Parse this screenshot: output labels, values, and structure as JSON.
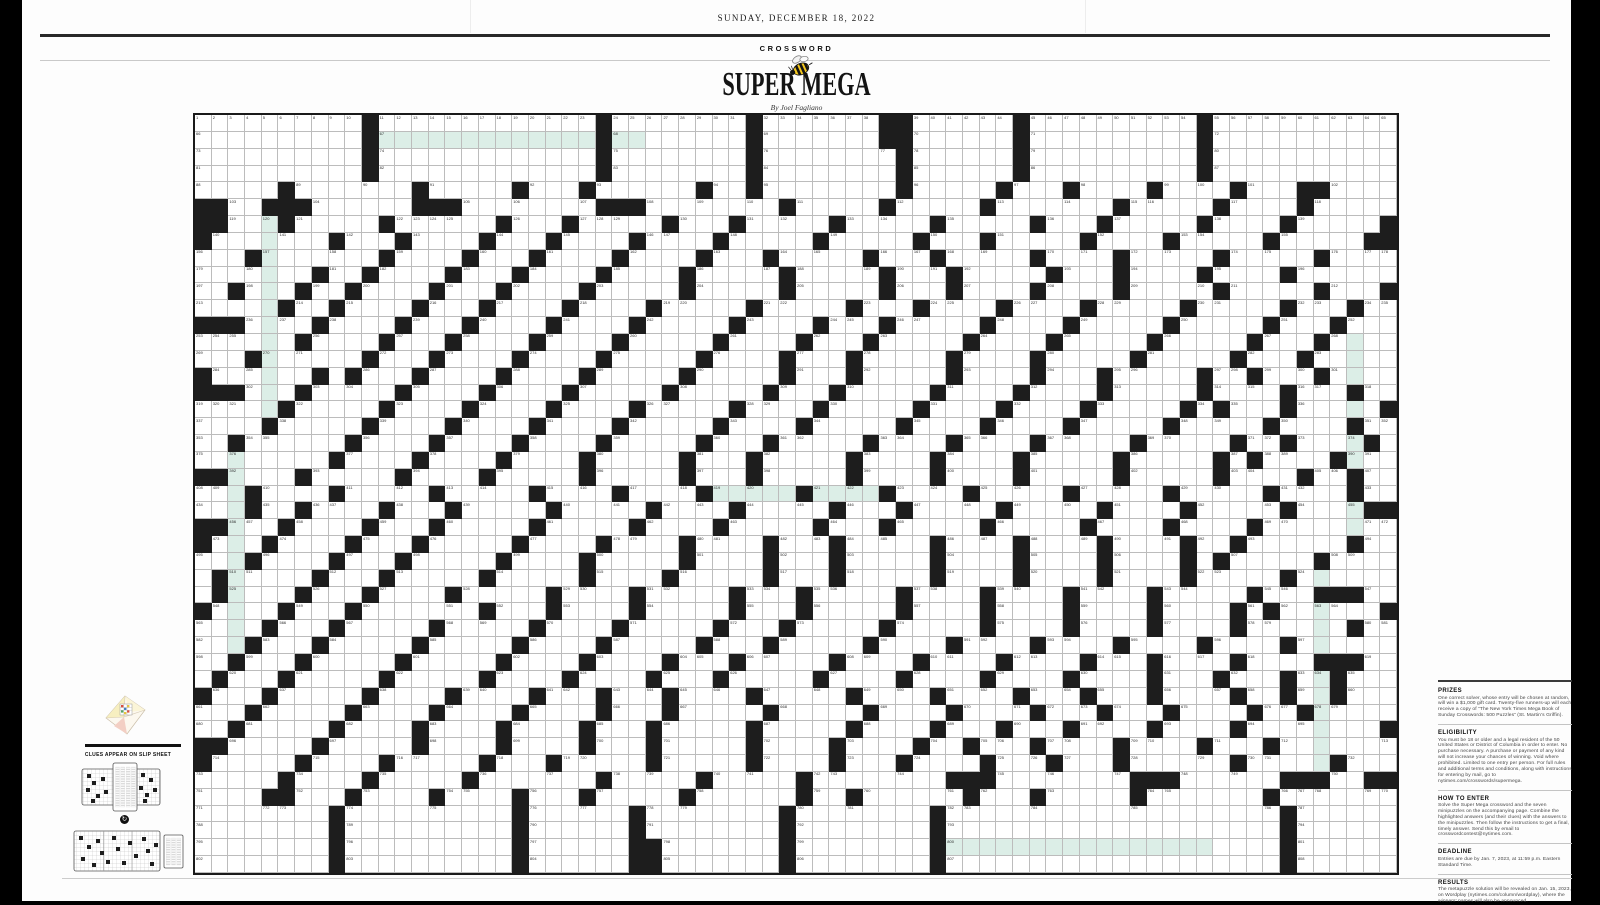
{
  "masthead": {
    "date": "SUNDAY, DECEMBER 18, 2022",
    "section_label": "CROSSWORD",
    "title": "SUPER MEGA",
    "byline": "By Joel Fagliano"
  },
  "puzzle": {
    "rows": 45,
    "cols": 72,
    "colors": {
      "black": "#1d1d1d",
      "highlight": "#dceee7",
      "gridline": "#bcbcbc",
      "border": "#1a1a1a"
    },
    "grid": [
      "..........#.............#........#.......##......#..........#........",
      "..........#.............#........#.......##......#..........#........",
      "..........#.............#........#........#......#..........#........",
      "..........#.............#........#........#......#..........#........",
      ".....#.......#.....#...#......#..#........#.....#...#....#....#...##....",
      "##..###......###........###........#.....#.....#.......#.....#....#.....",
      "##...#.....#......#...#.....#...#.....#.....#.....#...#.....#....#.....#",
      "#.......#...#....#...#....#....#.....#.....#...#.....#....#.....#.....##",
      "...#.......#....#...#....#....#...#.....#...#.....#....#.....#.....#..",
      ".......#..#....#...#....#....#.....#.....#...#.....#...#....#....#.....",
      "..#...#..#....#...#....#.....#.....#.....#...#....#....#.....#.....#...#",
      ".....#..#....#...#....#....#.....#.....#...#....#....#.....#.....#...#.",
      "###....#....#...#....#....#.....#....#...#.....#....#.....#.....#...#..",
      "......#....#...#....#....#.....#....#...#.....#....#.....#.....#...#...",
      "...#......#...#....#....#.....#....#...#.....#....#.....#.....#...#....",
      "#......#.#...#....#....#.....#.....#...#.....#....#...#.....#..#...#....#",
      "###...#.....#....#....#.....#.....#...#.....#....#....#.....#....#...#.",
      ".....#.....#....#....#....#.....#....#.....#....#....#.....#.#...#.....#.",
      "....#.....#....#....#....#.....#....#.....#....#....#.....#.....#....#...",
      "..#......#....#....#....#.....#...#.....#....#....#.....#.....#..#....#...#",
      "........#....#....#....#.....#...#.....#....#....#.....#.....#.#....#...##",
      "##....#.....#....#.....#.....#...#.....#....#....#.....#.....#....#..#...",
      "...#....#.....#.....#....#....#.....#....#....#.....#.....#.....#....#...",
      "...#..#....#...#.....#.....#....#.....#...#.....#.....#....#.....#....##",
      "##...#....#...#.....#.....#....#.....#...#.....#.....#....#....#........",
      "#...#....#...#.....#....#....#....#...#.....#....#....#....#..#......#..",
      "...#....#...#.....#....#.....#....#...#.....#....#....#....#.#.....#....",
      ".#.....#...#.....#.....#....#.....#...#.....#....#....#....#.....#.....",
      ".#....#...#....#.....#....#.....#...#.....#....#....#....#.....#...###",
      "#....#...#.......#...#....#.....#...#.....#....#....#....#....#.#......#",
      "....#...#.....#.....#....#.....#...#.....#.....#....#....#....#......#...",
      "...#...#.....#.....#....#.....#...#.....#....#....#....#....#....#......",
      "..#...#.....#.....#....#....#...#.....#....#....#....#...#....#....###",
      ".#...#.....#.....#....#....#...#.....#....#....#....#....#...#...#..#.....",
      "#...#.....#....#....#...#...#....#.....#....#....#...#...#....#..#..#...#..",
      "...#.....#....#....#....#...#.....#.....#....#....#...#...#....#..#.......",
      "..#.....#....#....#....#...#.....#.....#....#...#...#....#....#........#...",
      "##.....#.....#....#....#...#.....#....#....#..#...#....#....#...#.......#",
      "#.....#....#.....#...#.....#.....#....#...#....#...#...#......#.....#...##",
      ".....#....#.....#.......#.....#.....#........###........###......###..##",
      "....##...#....#....#...#.....#......#..#......#...#.....#.......#.....",
      "........#..........#......#........#........#....................#..........",
      "........#..........#......#........#........#....................#..........",
      "........#..........#......##.......#........#....................#..........",
      "........#..........#......##.......#........#....................#.........."
    ],
    "grid_note": "rows of 72 cells: . = white square, # = black square",
    "highlights": [
      {
        "dir": "across",
        "row": 1,
        "start": 11,
        "end": 26
      },
      {
        "dir": "down",
        "col": 4,
        "start": 6,
        "end": 17
      },
      {
        "dir": "down",
        "col": 2,
        "start": 20,
        "end": 31
      },
      {
        "dir": "down",
        "col": 69,
        "start": 13,
        "end": 24
      },
      {
        "dir": "across",
        "row": 22,
        "start": 31,
        "end": 40
      },
      {
        "dir": "down",
        "col": 67,
        "start": 27,
        "end": 38
      },
      {
        "dir": "across",
        "row": 43,
        "start": 45,
        "end": 60
      }
    ]
  },
  "left_block": {
    "slip_label": "CLUES APPEAR ON SLIP SHEET",
    "rotate_glyph": "↻",
    "icons": [
      "folded-puzzle-envelope-icon",
      "slip-sheet-over-grid-diagram",
      "rotate-arrow-icon",
      "slip-sheet-beside-grid-diagram"
    ]
  },
  "sidebar": {
    "sections": [
      {
        "heading": "PRIZES",
        "body": "One correct solver, whose entry will be chosen at random, will win a $1,000 gift card. Twenty-five runners-up will each receive a copy of “The New York Times Mega Book of Sunday Crosswords: 500 Puzzles” (St. Martin’s Griffin)."
      },
      {
        "heading": "ELIGIBILITY",
        "body": "You must be 18 or older and a legal resident of the 50 United States or District of Columbia in order to enter. No purchase necessary. A purchase or payment of any kind will not increase your chances of winning. Void where prohibited. Limited to one entry per person. For full rules and additional terms and conditions, along with instructions for entering by mail, go to nytimes.com/crosswords/supermega."
      },
      {
        "heading": "HOW TO ENTER",
        "body": "Solve the Super Mega crossword and the seven minipuzzles on the accompanying page. Combine the highlighted answers (and their clues) with the answers to the minipuzzles. Then follow the instructions to get a final, timely answer. Send this by email to crosswordcontest@nytimes.com."
      },
      {
        "heading": "DEADLINE",
        "body": "Entries are due by Jan. 7, 2023, at 11:59 p.m. Eastern Standard Time."
      },
      {
        "heading": "RESULTS",
        "body": "The metapuzzle solution will be revealed on Jan. 15, 2023, on Wordplay (nytimes.com/column/wordplay), where the winners’ names will also be announced."
      }
    ]
  }
}
